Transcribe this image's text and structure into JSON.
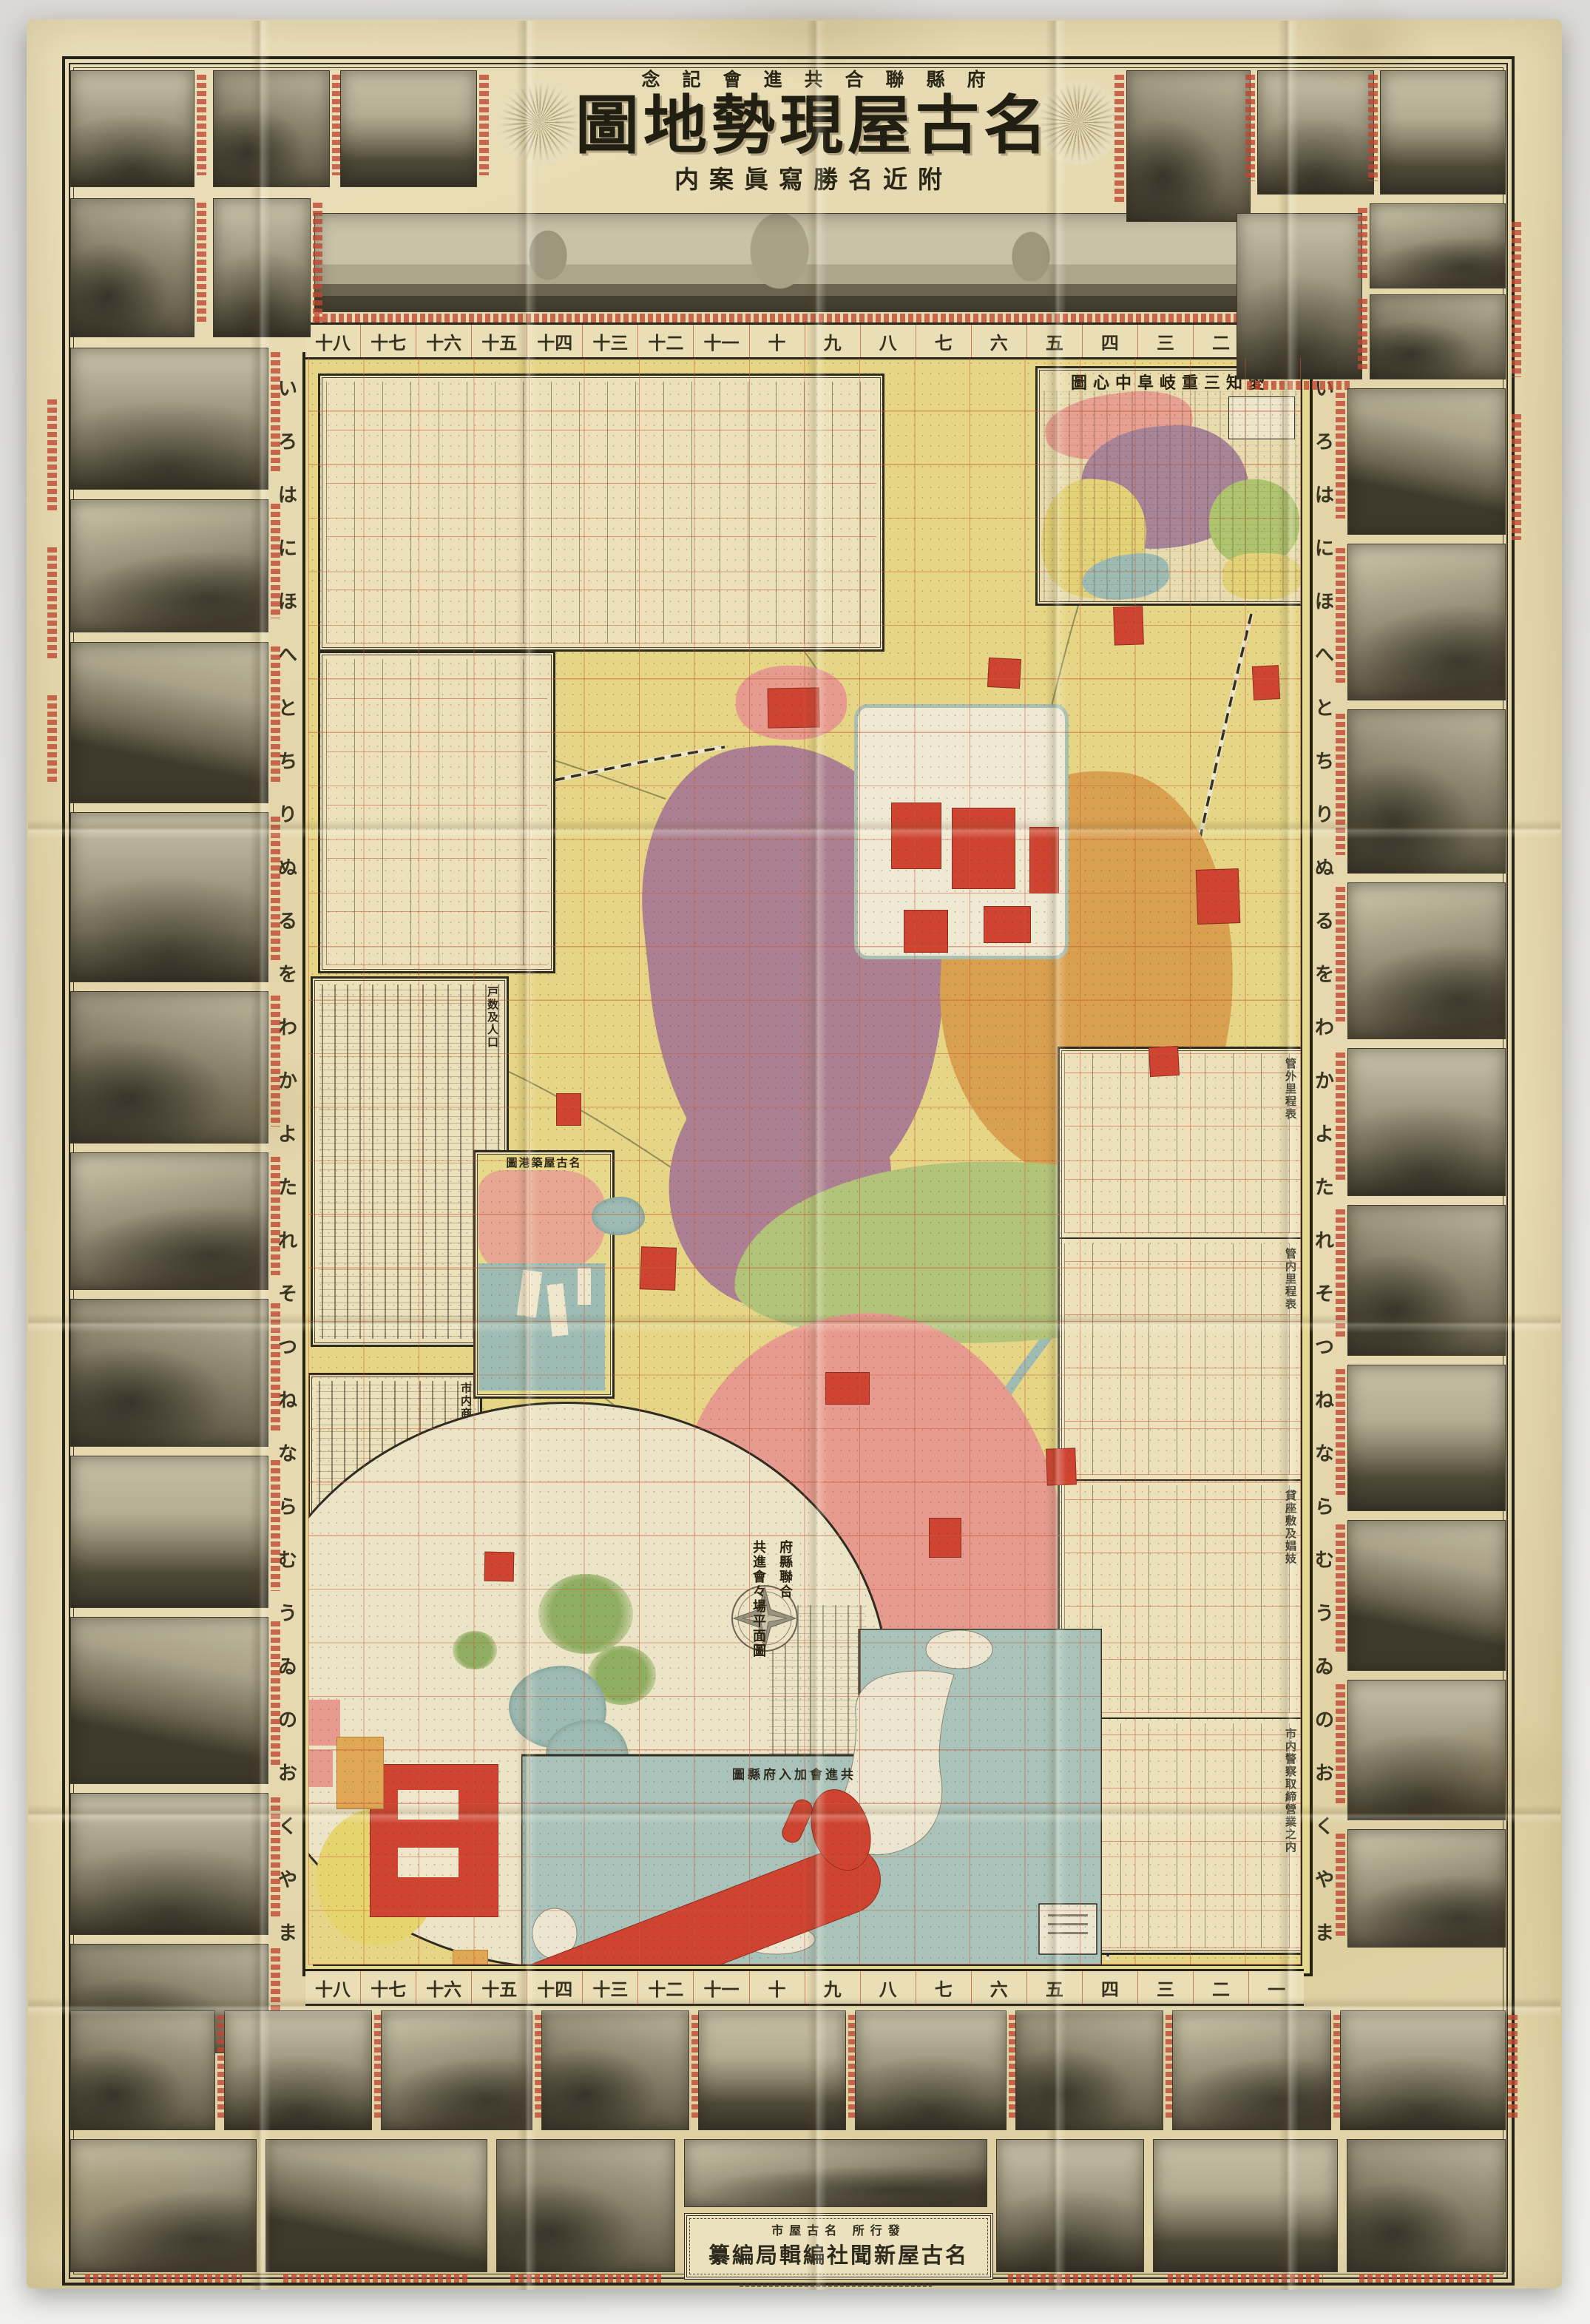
{
  "colors": {
    "paper": "#e7dbb2",
    "ink": "#2e2a1e",
    "red": "#bf4530",
    "gridred": "#c65a36",
    "myellow": "#e5d584",
    "mauve": "#ac8092",
    "orange": "#d9a050",
    "green": "#b2c47a",
    "pink": "#e79b8e",
    "bred": "#cf4331",
    "water": "#9fbcb4",
    "castle": "#efe8d2",
    "tblbg": "#ebe0ba"
  },
  "header": {
    "commemoration": "念記會進共合聯縣府",
    "title": "圖地勢現屋古名",
    "subtitle": "内案眞寫勝名近附"
  },
  "margins": {
    "columns_display": [
      "十八",
      "十七",
      "十六",
      "十五",
      "十四",
      "十三",
      "十二",
      "十一",
      "十",
      "九",
      "八",
      "七",
      "六",
      "五",
      "四",
      "三",
      "二",
      "一"
    ],
    "iroha": [
      "い",
      "ろ",
      "は",
      "に",
      "ほ",
      "へ",
      "と",
      "ち",
      "り",
      "ぬ",
      "る",
      "を",
      "わ",
      "か",
      "よ",
      "た",
      "れ",
      "そ",
      "つ",
      "ね",
      "な",
      "ら",
      "む",
      "う",
      "ゐ",
      "の",
      "お",
      "く",
      "や",
      "ま"
    ]
  },
  "insets": {
    "regional": {
      "title": "圖心中阜岐重三知愛"
    },
    "port": {
      "title": "圖港築屋古名"
    },
    "expo": {
      "title_col1": "府縣聯合",
      "title_col2": "共進會々場平面圖"
    },
    "japan": {
      "title": "圖縣府入加會進共"
    }
  },
  "tables": {
    "right_sections": [
      {
        "title": "管外里程表"
      },
      {
        "title": "管内里程表"
      },
      {
        "title": "貸座敷及娼妓"
      },
      {
        "title": "市内警察取締營業之内"
      }
    ],
    "left_sections": [
      {
        "title": "戸数及人口"
      },
      {
        "title": "市内商買別"
      }
    ]
  },
  "publisher": {
    "line1": "市屋古名 所行發",
    "line2": "纂編局輯編社聞新屋古名"
  },
  "photos": [
    [
      95,
      95,
      168,
      158,
      2,
      "r"
    ],
    [
      288,
      95,
      158,
      158,
      3,
      "r"
    ],
    [
      460,
      95,
      185,
      158,
      1,
      "r"
    ],
    [
      95,
      268,
      168,
      188,
      3,
      "r"
    ],
    [
      288,
      268,
      132,
      188,
      2,
      "r"
    ],
    [
      95,
      470,
      268,
      192,
      2,
      "r"
    ],
    [
      95,
      675,
      268,
      180,
      4,
      "r"
    ],
    [
      95,
      868,
      268,
      218,
      5,
      "r"
    ],
    [
      95,
      1098,
      268,
      230,
      2,
      "r"
    ],
    [
      95,
      1340,
      268,
      206,
      3,
      "r"
    ],
    [
      95,
      1558,
      268,
      186,
      4,
      "r"
    ],
    [
      95,
      1756,
      268,
      200,
      3,
      "r"
    ],
    [
      95,
      1968,
      268,
      206,
      1,
      "r"
    ],
    [
      95,
      2186,
      268,
      226,
      5,
      "r"
    ],
    [
      95,
      2424,
      268,
      192,
      2,
      "r"
    ],
    [
      95,
      2628,
      268,
      148,
      3,
      "r"
    ],
    [
      1523,
      95,
      168,
      205,
      3,
      "l"
    ],
    [
      1700,
      95,
      158,
      168,
      2,
      "l"
    ],
    [
      1866,
      95,
      170,
      168,
      1,
      "l"
    ],
    [
      1672,
      288,
      170,
      225,
      2,
      "b"
    ],
    [
      1852,
      275,
      184,
      115,
      4,
      "l"
    ],
    [
      1852,
      398,
      184,
      115,
      3,
      "l"
    ],
    [
      1822,
      525,
      214,
      198,
      5,
      "l"
    ],
    [
      1822,
      735,
      214,
      212,
      4,
      "l"
    ],
    [
      1822,
      959,
      214,
      222,
      3,
      "l"
    ],
    [
      1822,
      1193,
      214,
      212,
      4,
      "l"
    ],
    [
      1822,
      1417,
      214,
      200,
      2,
      "l"
    ],
    [
      1822,
      1629,
      214,
      204,
      3,
      "l"
    ],
    [
      1822,
      1845,
      214,
      198,
      1,
      "l"
    ],
    [
      1822,
      2055,
      214,
      204,
      5,
      "l"
    ],
    [
      1822,
      2271,
      214,
      190,
      2,
      "l"
    ],
    [
      1822,
      2473,
      214,
      160,
      4,
      "l"
    ],
    [
      95,
      2718,
      196,
      162,
      3,
      "r"
    ],
    [
      303,
      2718,
      200,
      162,
      2,
      "r"
    ],
    [
      515,
      2718,
      205,
      162,
      4,
      "r"
    ],
    [
      732,
      2718,
      200,
      162,
      3,
      "r"
    ],
    [
      944,
      2718,
      200,
      162,
      1,
      "r"
    ],
    [
      1156,
      2718,
      205,
      162,
      2,
      "r"
    ],
    [
      1373,
      2718,
      200,
      162,
      3,
      "r"
    ],
    [
      1585,
      2718,
      215,
      162,
      4,
      "r"
    ],
    [
      1812,
      2718,
      224,
      162,
      2,
      "r"
    ],
    [
      95,
      2892,
      252,
      180,
      4,
      "b"
    ],
    [
      359,
      2892,
      300,
      180,
      5,
      "b"
    ],
    [
      671,
      2892,
      242,
      180,
      3,
      "b"
    ],
    [
      925,
      2892,
      410,
      92,
      4,
      ""
    ],
    [
      1347,
      2892,
      200,
      180,
      2,
      "b"
    ],
    [
      1559,
      2892,
      250,
      180,
      1,
      "b"
    ],
    [
      1821,
      2892,
      215,
      180,
      3,
      "b"
    ]
  ],
  "map_art": {
    "districts": [
      [
        878,
        1005,
        400,
        620,
        "mauve",
        -6,
        "42% 58% 55% 45% / 38% 46% 60% 52%"
      ],
      [
        905,
        1430,
        300,
        340,
        "mauve",
        8,
        "50%"
      ],
      [
        995,
        900,
        150,
        100,
        "pink",
        0,
        "45%"
      ],
      [
        1272,
        1042,
        395,
        560,
        "orange",
        3,
        "55% 45% 40% 60% / 45% 55% 50% 50%"
      ],
      [
        992,
        1570,
        700,
        245,
        "green",
        -2,
        "45% 55% 50% 50% / 65% 55% 45% 35%"
      ],
      [
        925,
        1775,
        515,
        620,
        "pink",
        -4,
        "50% 50% 45% 55% / 40% 55% 45% 60%"
      ],
      [
        1035,
        2300,
        320,
        280,
        "pink",
        6,
        "48%"
      ]
    ],
    "red_patches": [
      [
        1038,
        930,
        68,
        52
      ],
      [
        1336,
        890,
        42,
        38
      ],
      [
        1506,
        820,
        38,
        50
      ],
      [
        1618,
        1175,
        56,
        72
      ],
      [
        866,
        1686,
        46,
        56
      ],
      [
        1116,
        1855,
        58,
        42
      ],
      [
        1256,
        2052,
        42,
        52
      ],
      [
        1415,
        1958,
        38,
        48
      ],
      [
        655,
        2098,
        38,
        38
      ],
      [
        1554,
        1415,
        38,
        38
      ],
      [
        752,
        1478,
        32,
        42
      ],
      [
        1694,
        900,
        34,
        44
      ]
    ],
    "castle_buildings": [
      [
        1205,
        1085,
        66,
        88
      ],
      [
        1287,
        1092,
        84,
        108
      ],
      [
        1330,
        1225,
        62,
        48
      ],
      [
        1222,
        1230,
        58,
        56
      ],
      [
        1392,
        1118,
        38,
        88
      ]
    ],
    "expo_red": [
      [
        500,
        2385,
        172,
        205
      ],
      [
        715,
        2455,
        152,
        118
      ],
      [
        903,
        2412,
        175,
        198
      ]
    ],
    "expo_slots": [
      [
        538,
        2420,
        82,
        40
      ],
      [
        538,
        2498,
        82,
        40
      ],
      [
        948,
        2448,
        82,
        44
      ],
      [
        948,
        2528,
        82,
        44
      ],
      [
        742,
        2484,
        82,
        40
      ]
    ],
    "expo_orange": [
      [
        455,
        2348,
        62,
        96
      ],
      [
        838,
        2618,
        56,
        34
      ],
      [
        908,
        2622,
        62,
        34
      ],
      [
        982,
        2612,
        56,
        34
      ],
      [
        1050,
        2598,
        52,
        30
      ],
      [
        612,
        2636,
        46,
        28
      ]
    ],
    "trees": [
      [
        728,
        2128,
        128,
        108
      ],
      [
        795,
        2225,
        92,
        80
      ],
      [
        612,
        2205,
        60,
        52
      ]
    ],
    "ponds": [
      [
        688,
        2252,
        132,
        112
      ],
      [
        738,
        2325,
        112,
        92
      ],
      [
        800,
        1618,
        72,
        52
      ]
    ],
    "expo_yellow": [
      [
        428,
        2445,
        165,
        185
      ]
    ],
    "expo_pink": [
      [
        418,
        2298,
        42,
        62
      ],
      [
        414,
        2366,
        36,
        50
      ]
    ]
  }
}
